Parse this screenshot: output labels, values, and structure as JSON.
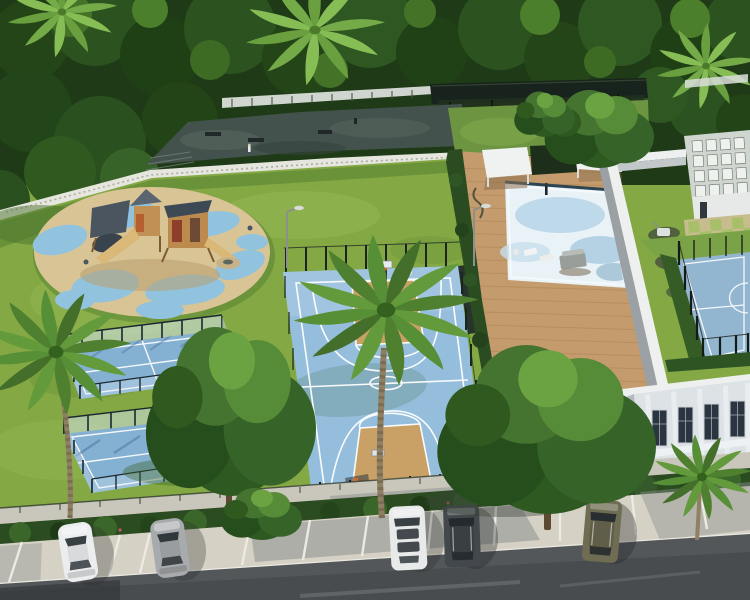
{
  "meta": {
    "title": "Aerial 3D rendering of a residential amenity park",
    "description": "Sunlit aerial view of a landscaped recreation area with playground, sports courts, swimming pool, clubhouse building and angled parking along a road",
    "time_of_day": "daytime",
    "style": "photorealistic architectural rendering"
  },
  "palette": {
    "lawn": "#83a844",
    "lawnLight": "#9cbf5c",
    "lawnDark": "#5f8733",
    "treeDark": "#1e3a16",
    "treeMid": "#2f5a23",
    "courtBlue": "#94bedc",
    "courtTan": "#c9a166",
    "padelBlue": "#84b0d2",
    "playSand": "#d9c496",
    "playBlue": "#92c3de",
    "deckWood": "#c49b6c",
    "poolWater": "#e9f3f7",
    "buildingFace": "#dde2e6",
    "buildingShade": "#b4bac1",
    "wallTop": "#eef0f0",
    "hedge": "#2b4c21",
    "walkway": "#c9c6bb",
    "parkingSurface": "#d6d1c5",
    "road": "#53575a",
    "plaza": "#43524c",
    "pergola": "#17231c",
    "gravel": "#e6e6de",
    "carWhite": "#ecedee",
    "carSilver": "#a8abad",
    "carDark": "#42484c",
    "carOlive": "#6e6c52",
    "lineWhite": "#ffffff"
  },
  "scene": {
    "areas": [
      {
        "id": "tree-canopy",
        "label": "Dense tree canopy"
      },
      {
        "id": "shaded-plaza",
        "label": "Shaded plaza with benches"
      },
      {
        "id": "pergola-lounge",
        "label": "Dark pergola lounge"
      },
      {
        "id": "main-lawn",
        "label": "Open lawn"
      },
      {
        "id": "playground",
        "label": "Playground on blue and sand safety surface"
      },
      {
        "id": "basketball-court",
        "label": "Blue basketball court with tan keys"
      },
      {
        "id": "padel-courts",
        "label": "Two glass-walled padel courts"
      },
      {
        "id": "pool-deck",
        "label": "Timber pool deck"
      },
      {
        "id": "swimming-pool",
        "label": "Swimming pool"
      },
      {
        "id": "outdoor-gym",
        "label": "Outdoor gym corner"
      },
      {
        "id": "checkered-patio",
        "label": "Checkered grass-paver patio"
      },
      {
        "id": "rooftop-court",
        "label": "Fenced sports court by clubhouse"
      },
      {
        "id": "clubhouse",
        "label": "White clubhouse building"
      },
      {
        "id": "utility-building",
        "label": "Flat-roof utility building"
      },
      {
        "id": "walkway",
        "label": "Pedestrian walkway"
      },
      {
        "id": "hedge-row",
        "label": "Perimeter hedge"
      },
      {
        "id": "parking",
        "label": "Angled parking bays"
      },
      {
        "id": "road",
        "label": "Asphalt road"
      }
    ],
    "vehicles": [
      {
        "id": "car-1",
        "type": "sedan",
        "color_name": "white"
      },
      {
        "id": "car-2",
        "type": "sedan",
        "color_name": "silver"
      },
      {
        "id": "car-3",
        "type": "van",
        "color_name": "white"
      },
      {
        "id": "car-4",
        "type": "suv",
        "color_name": "dark gray"
      },
      {
        "id": "car-5",
        "type": "suv",
        "color_name": "olive"
      }
    ],
    "counts": {
      "cars": 5,
      "padel_courts": 2,
      "basketball_hoops": 2,
      "pool_pergolas": 2,
      "street_lamps": 2,
      "large_palm_trees": 3
    }
  }
}
